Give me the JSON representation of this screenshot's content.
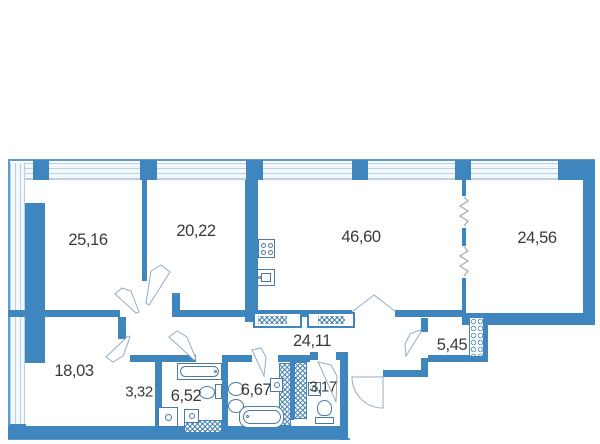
{
  "title": "apartment-floor-plan",
  "rooms": [
    {
      "key": "room-1",
      "area": "25,16"
    },
    {
      "key": "room-2",
      "area": "20,22"
    },
    {
      "key": "kitchen-living-room",
      "area": "46,60"
    },
    {
      "key": "room-3",
      "area": "24,56"
    },
    {
      "key": "room-4",
      "area": "18,03"
    },
    {
      "key": "hallway-small",
      "area": "3,32"
    },
    {
      "key": "bathroom-1",
      "area": "6,52"
    },
    {
      "key": "bathroom-2",
      "area": "6,67"
    },
    {
      "key": "wc",
      "area": "3,17"
    },
    {
      "key": "corridor",
      "area": "24,11"
    },
    {
      "key": "storage",
      "area": "5,45"
    }
  ],
  "fixtures": {
    "kitchen": [
      "stove-icon",
      "kitchen-sink-icon"
    ],
    "bathroom_652": [
      "bathtub-icon",
      "toilet-icon",
      "washing-machine-icon",
      "sink-icon"
    ],
    "bathroom_667": [
      "sink-icon",
      "sink-icon",
      "small-sink-icon",
      "bathtub-icon"
    ],
    "wc_317": [
      "sink-icon",
      "toilet-icon"
    ]
  },
  "symbols": [
    "door-leaf-icon",
    "entrance-door-arc-icon",
    "double-door-icon",
    "zigzag-partition-icon",
    "vent-shaft-hatch",
    "wardrobe-hatch",
    "window-glazing"
  ],
  "colors": {
    "wall": "#3e86bd",
    "outline": "#5b9bcd",
    "glazing_line": "#b9d0e6",
    "fixture_line": "#4a7aa3",
    "zigzag": "#a8a8a8",
    "label_text": "#3a3a3a",
    "background": "#ffffff"
  }
}
